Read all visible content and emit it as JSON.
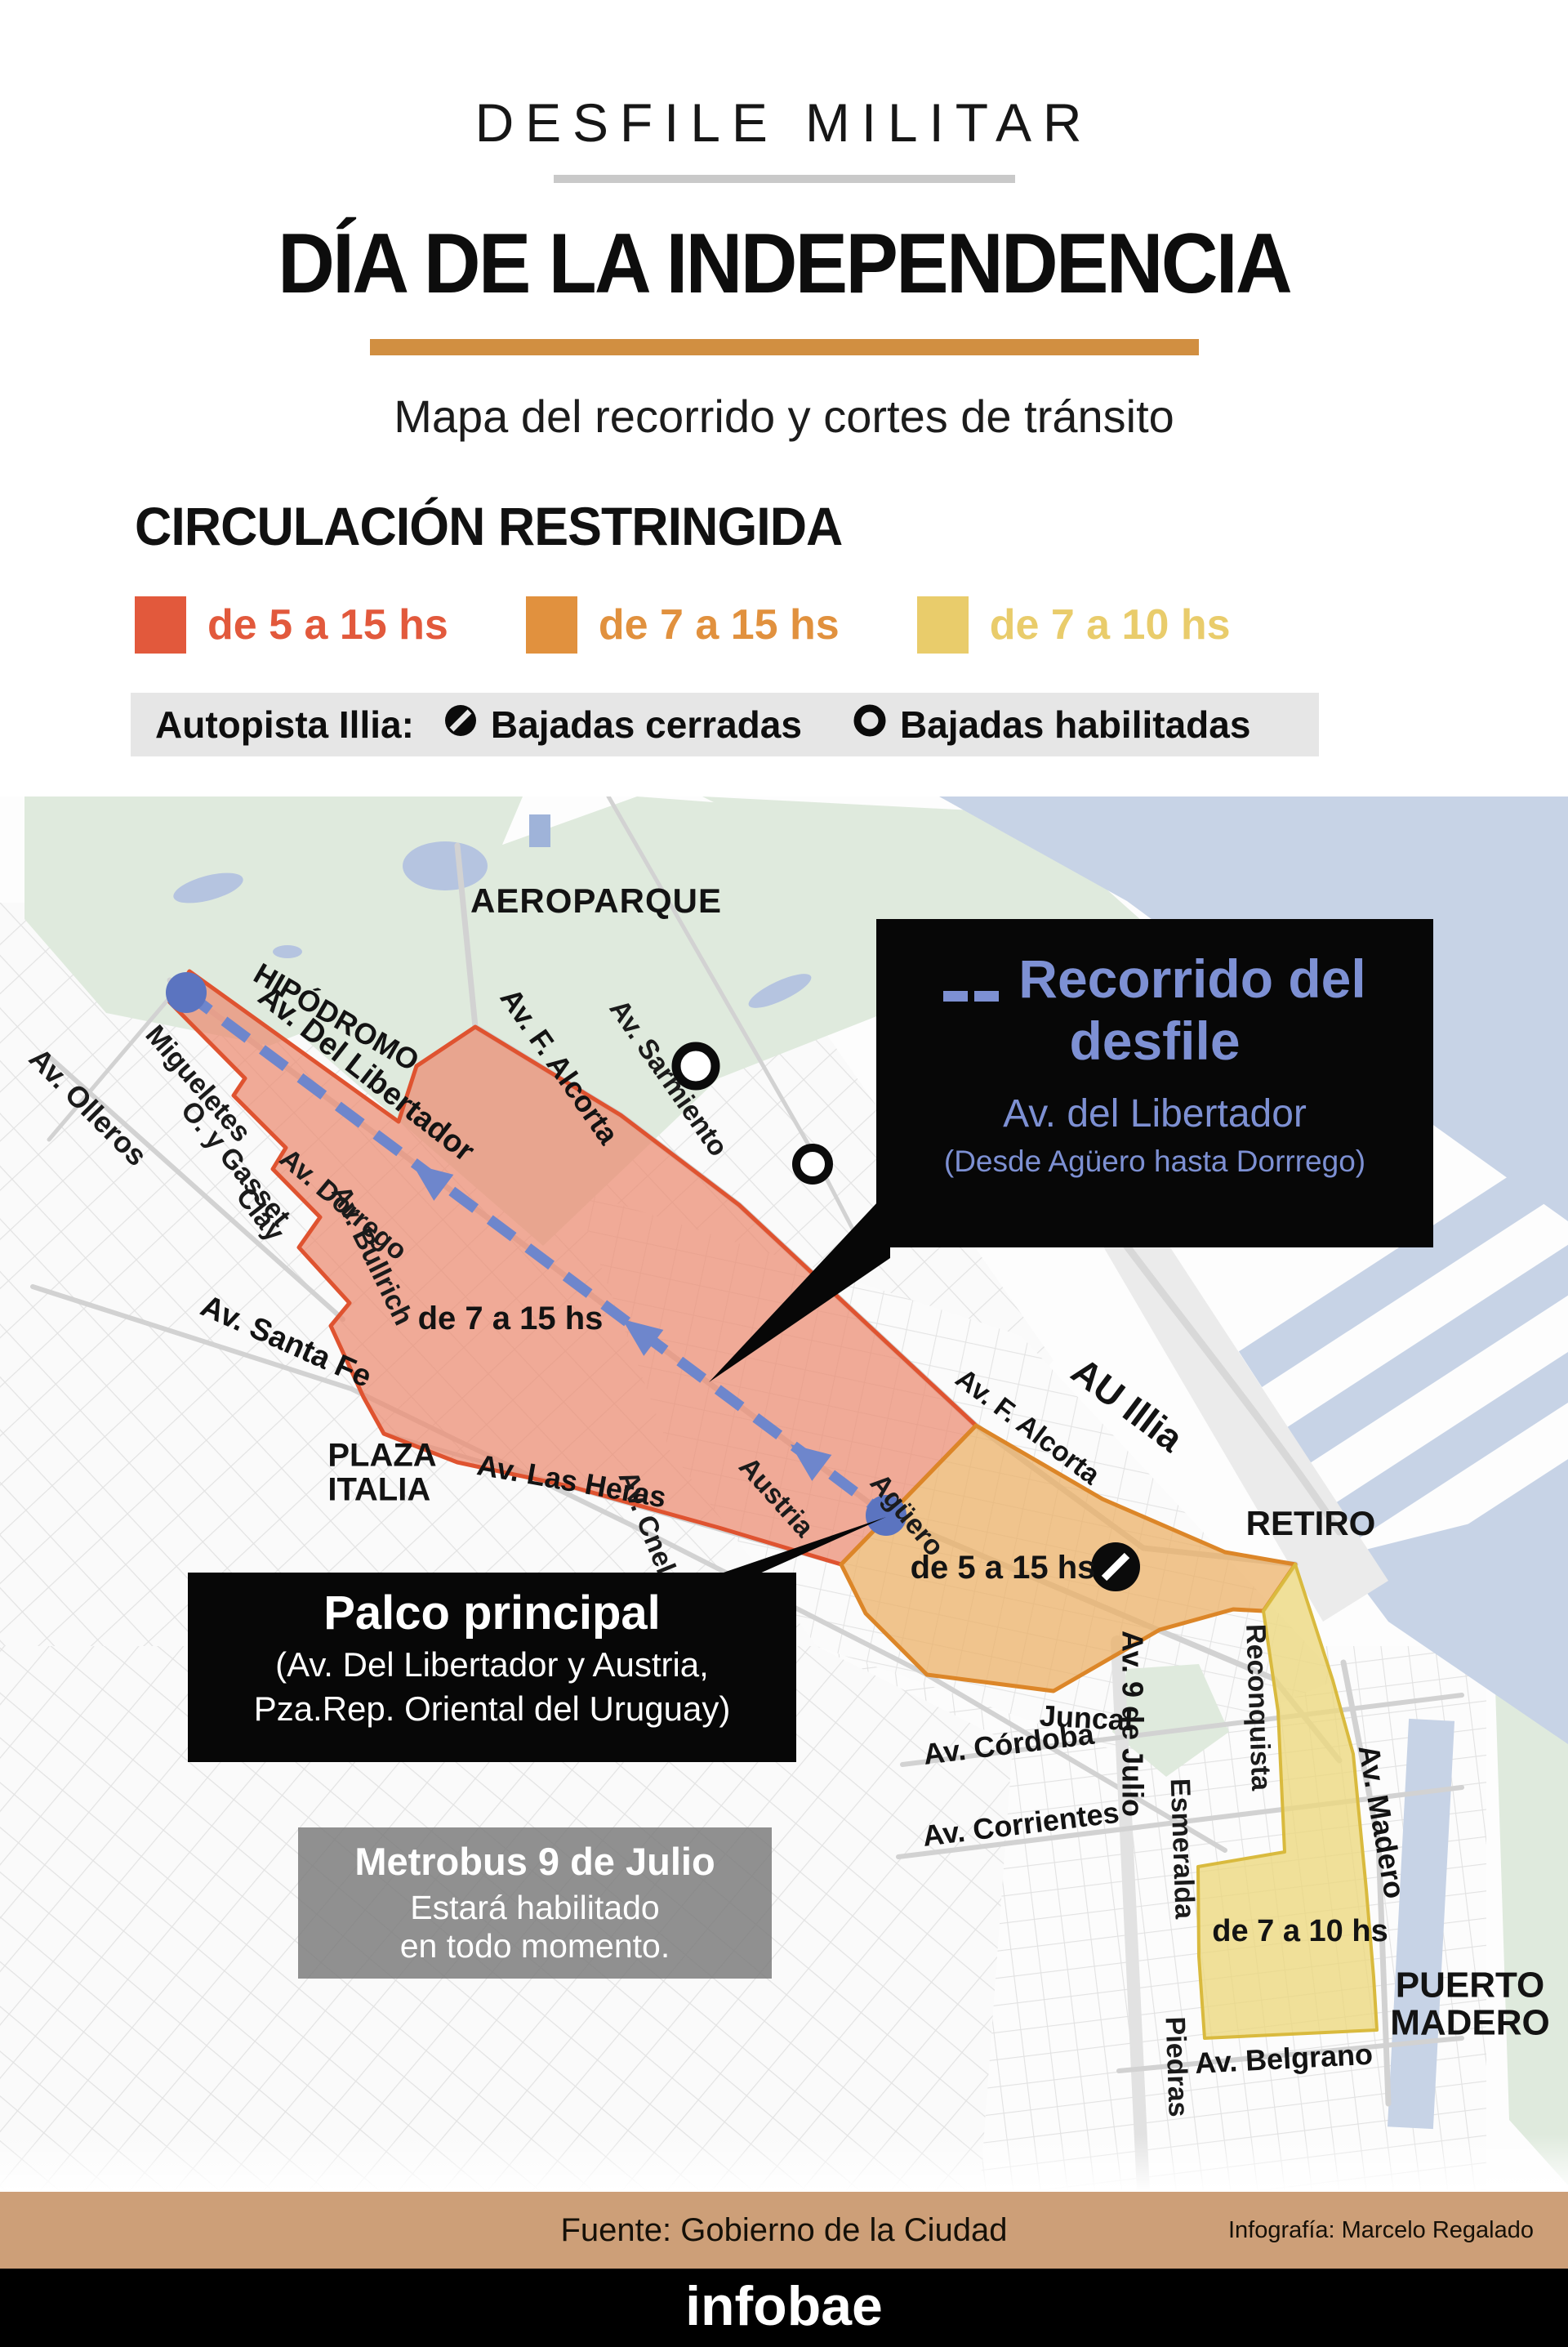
{
  "header": {
    "kicker": "DESFILE MILITAR",
    "title": "DÍA DE LA INDEPENDENCIA",
    "subtitle": "Mapa del recorrido y cortes de tránsito"
  },
  "legend": {
    "heading": "CIRCULACIÓN RESTRINGIDA",
    "items": [
      {
        "label": "de 5 a 15 hs",
        "color": "#e2593c"
      },
      {
        "label": "de 7 a 15 hs",
        "color": "#e1913e"
      },
      {
        "label": "de 7 a 10 hs",
        "color": "#e9cc6b"
      }
    ],
    "note": {
      "prefix": "Autopista Illia:",
      "closed_icon": "no-entry-icon",
      "closed": "Bajadas cerradas",
      "open_icon": "ring-icon",
      "open": "Bajadas habilitadas"
    }
  },
  "map": {
    "labels": [
      "AEROPARQUE",
      "HIPÓDROMO",
      "Av. Del Libertador",
      "Av. F. Alcorta",
      "Av. Sarmiento",
      "Av. Olleros",
      "Migueletes",
      "O. y Gasset",
      "Clay",
      "Av. Dorrego",
      "Av. Bullrich",
      "de 7 a 15 hs",
      "Av. Santa Fe",
      "PLAZA\nITALIA",
      "Av. Las Heras",
      "Av. Cnel. Díaz",
      "Austria",
      "Agüero",
      "Av. F. Alcorta",
      "AU Illia",
      "de 5 a 15 hs",
      "RETIRO",
      "Juncal",
      "Av. 9 de Julio",
      "Reconquista",
      "Av. Córdoba",
      "Av. Corrientes",
      "Esmeralda",
      "Av. Madero",
      "de 7 a 10 hs",
      "Piedras",
      "Av. Belgrano",
      "PUERTO\nMADERO"
    ],
    "route_callout": {
      "icon": "dashed-route-icon",
      "title": "Recorrido del desfile",
      "subtitle": "Av. del Libertador",
      "detail": "(Desde Agüero hasta Dorrrego)"
    },
    "palco_callout": {
      "title": "Palco principal",
      "address_line1": "(Av. Del Libertador y Austria,",
      "address_line2": "Pza.Rep. Oriental del Uruguay)"
    },
    "metrobus_callout": {
      "title": "Metrobus 9 de Julio",
      "body_line1": "Estará habilitado",
      "body_line2": "en todo momento."
    }
  },
  "colors": {
    "accent_red": "#e2593c",
    "accent_orange": "#e1913e",
    "accent_yellow": "#e9cc6b",
    "zone_red_stroke": "#df5330",
    "zone_orange_stroke": "#dc8628",
    "zone_yellow_stroke": "#d9ba3e",
    "route_blue": "#6e86cc",
    "callout_blue": "#7d90d3",
    "title_rule": "#d18f41",
    "water": "#c7d3e6",
    "park": "#dfeadd",
    "footer_bar": "#cd9f78"
  },
  "footer": {
    "source": "Fuente: Gobierno de la Ciudad",
    "credit": "Infografía: Marcelo Regalado",
    "brand": "infobae"
  }
}
